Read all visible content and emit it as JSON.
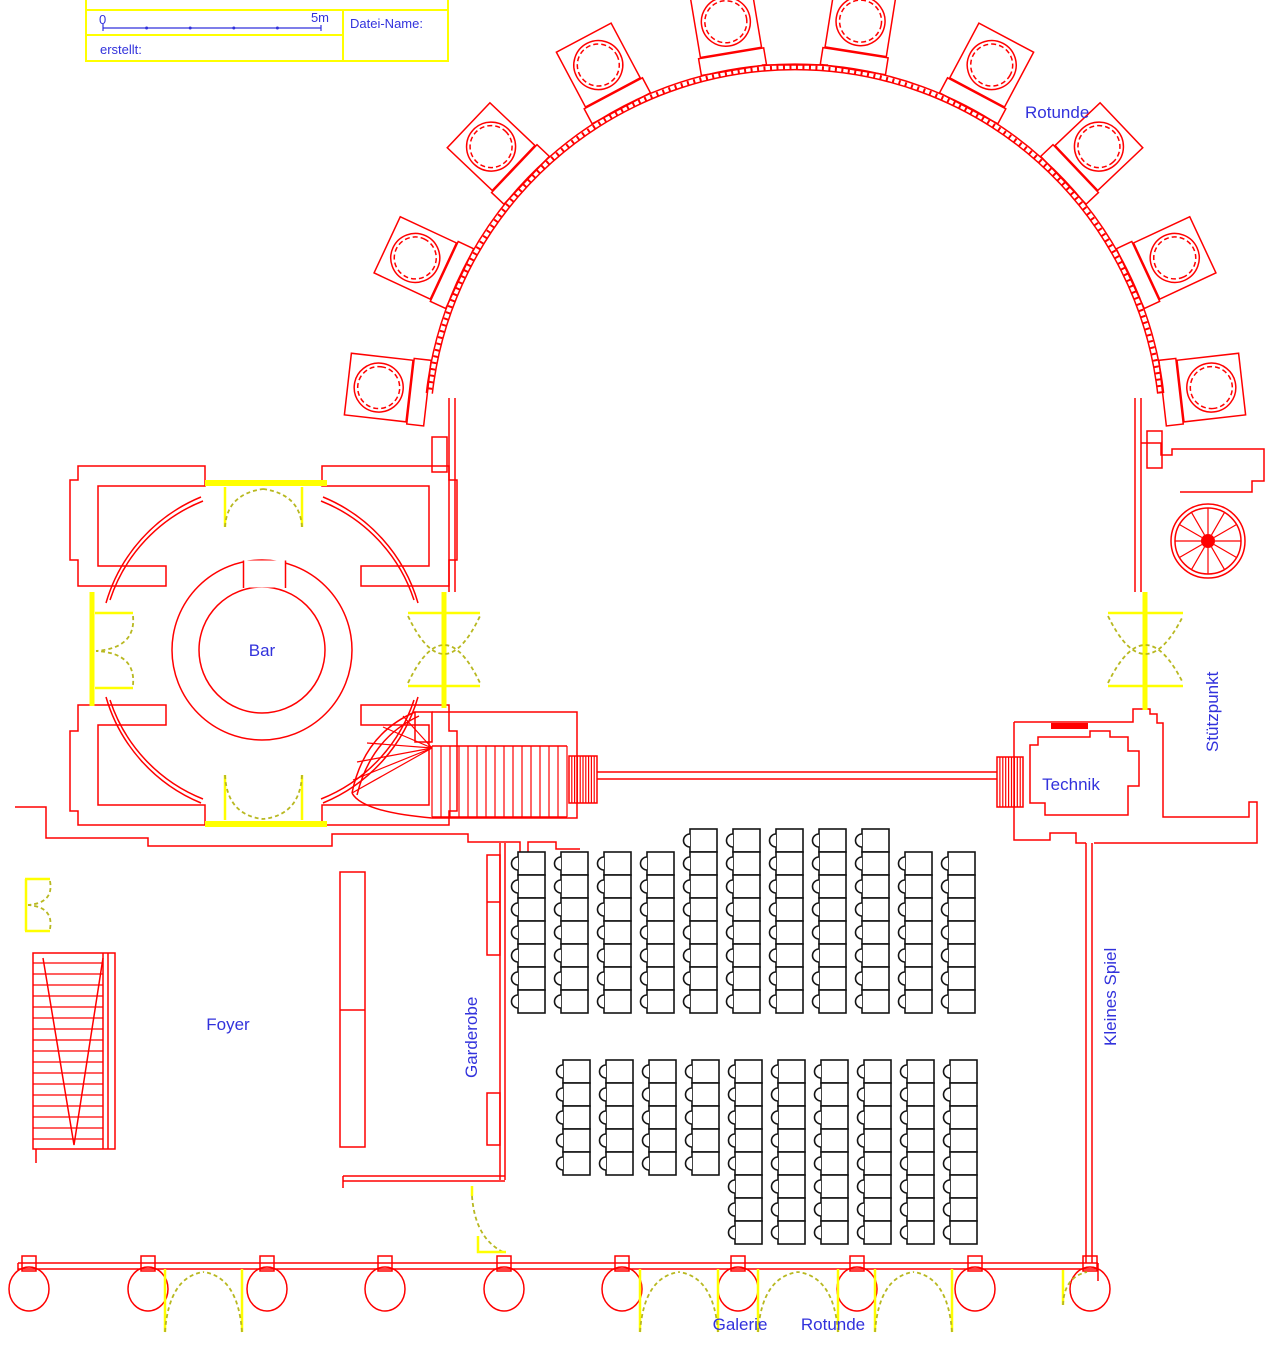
{
  "title_block": {
    "datei_name": "Datei-Name:",
    "erstellt": "erstellt:",
    "scale_start": "0",
    "scale_end": "5m"
  },
  "labels": {
    "rotunde_top": "Rotunde",
    "bar": "Bar",
    "technik": "Technik",
    "stuetzpunkt": "Stützpunkt",
    "kleines_spiel": "Kleines Spiel",
    "foyer": "Foyer",
    "garderobe": "Garderobe",
    "galerie": "Galerie",
    "rotunde_bottom": "Rotunde"
  },
  "colors": {
    "wall": "#ff0000",
    "door": "#ffff00",
    "door_swing": "#b8b820",
    "text": "#3232dc",
    "seat": "#141414",
    "background": "#ffffff"
  },
  "icons": {
    "rotunda_column": "column-icon",
    "spiral_stair": "spiral-staircase-icon",
    "door_swing": "door-swing-icon",
    "stair": "staircase-icon",
    "scale_bar": "scale-bar-icon"
  },
  "rotunda": {
    "center_x": 795,
    "center_y": 435,
    "radius": 370,
    "column_angles": [
      6.5,
      25,
      43.5,
      62,
      81,
      99.5,
      118,
      136.5,
      155,
      173.5
    ]
  },
  "seating": {
    "seat_w": 27,
    "seat_h": 23,
    "bump_r": 6.5,
    "blocks": [
      {
        "name": "upper",
        "columns": [
          {
            "x": 518,
            "y": 852,
            "n": 7
          },
          {
            "x": 561,
            "y": 852,
            "n": 7
          },
          {
            "x": 604,
            "y": 852,
            "n": 7
          },
          {
            "x": 647,
            "y": 852,
            "n": 7
          },
          {
            "x": 690,
            "y": 829,
            "n": 8
          },
          {
            "x": 733,
            "y": 829,
            "n": 8
          },
          {
            "x": 776,
            "y": 829,
            "n": 8
          },
          {
            "x": 819,
            "y": 829,
            "n": 8
          },
          {
            "x": 862,
            "y": 829,
            "n": 8
          },
          {
            "x": 905,
            "y": 852,
            "n": 7
          },
          {
            "x": 948,
            "y": 852,
            "n": 7
          }
        ]
      },
      {
        "name": "lower",
        "columns": [
          {
            "x": 563,
            "y": 1060,
            "n": 5
          },
          {
            "x": 606,
            "y": 1060,
            "n": 5
          },
          {
            "x": 649,
            "y": 1060,
            "n": 5
          },
          {
            "x": 692,
            "y": 1060,
            "n": 5
          },
          {
            "x": 735,
            "y": 1060,
            "n": 8
          },
          {
            "x": 778,
            "y": 1060,
            "n": 8
          },
          {
            "x": 821,
            "y": 1060,
            "n": 8
          },
          {
            "x": 864,
            "y": 1060,
            "n": 8
          },
          {
            "x": 907,
            "y": 1060,
            "n": 8
          },
          {
            "x": 950,
            "y": 1060,
            "n": 8
          }
        ]
      }
    ]
  },
  "colonnade": {
    "wall_y": 1263,
    "column_xs": [
      29,
      148,
      267,
      385,
      504,
      622,
      738,
      857,
      975,
      1090
    ],
    "doors": [
      {
        "x1": 165,
        "x2": 242
      },
      {
        "x1": 640,
        "x2": 718
      },
      {
        "x1": 758,
        "x2": 838
      },
      {
        "x1": 875,
        "x2": 952
      }
    ]
  }
}
